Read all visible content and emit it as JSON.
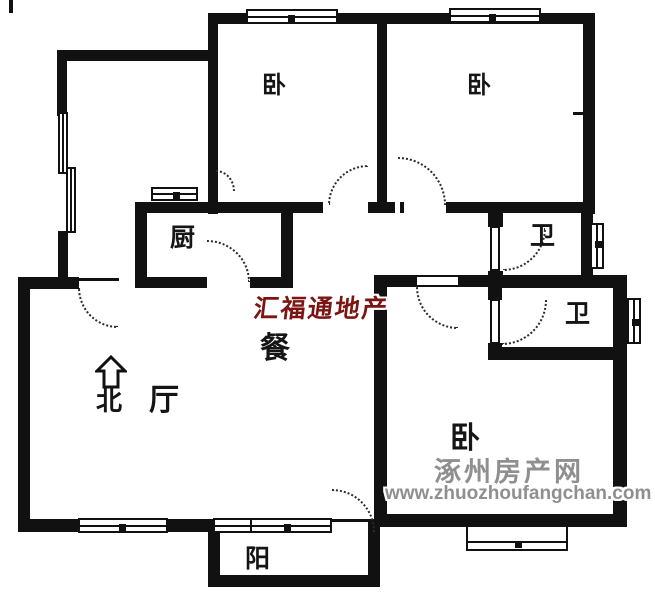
{
  "rooms": [
    {
      "id": "bedroom-1",
      "label": "卧"
    },
    {
      "id": "bedroom-2",
      "label": "卧"
    },
    {
      "id": "bedroom-3",
      "label": "卧"
    },
    {
      "id": "kitchen",
      "label": "厨"
    },
    {
      "id": "bathroom-1",
      "label": "卫"
    },
    {
      "id": "bathroom-2",
      "label": "卫"
    },
    {
      "id": "dining",
      "label": "餐"
    },
    {
      "id": "living",
      "label": "厅"
    },
    {
      "id": "balcony",
      "label": "阳"
    }
  ],
  "compass": {
    "label": "北",
    "direction": "north-up"
  },
  "watermarks": {
    "agency": {
      "text": "汇福通地产",
      "color": "#7c1511"
    },
    "site": {
      "name": "涿州房产网",
      "url": "www.zhuozhoufangchan.com",
      "color": "#8f8f8f"
    }
  },
  "colors": {
    "wall": "#111111",
    "background": "#ffffff",
    "door_arc": "#2b2b2b"
  }
}
